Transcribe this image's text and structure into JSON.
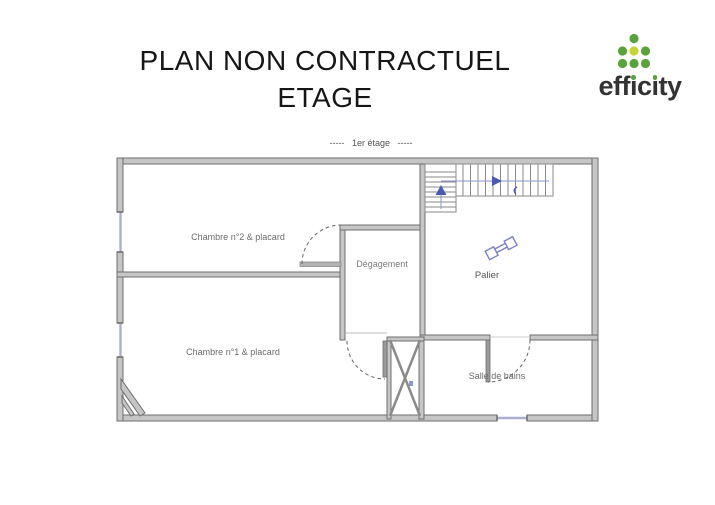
{
  "page": {
    "title_line1": "PLAN NON CONTRACTUEL",
    "title_line2": "ETAGE"
  },
  "logo": {
    "brand": "efficity",
    "brand_parts": {
      "pre": "eff",
      "i1": "ı",
      "mid": "c",
      "i2": "ı",
      "post": "ty"
    },
    "colors": {
      "dot_green": "#58a33c",
      "dot_yellow": "#c8d334",
      "text": "#333333"
    }
  },
  "plan": {
    "floor_label": "1er étage",
    "dashes_left": "----- ",
    "dashes_right": " -----",
    "rooms": [
      {
        "id": "chambre2",
        "label": "Chambre n°2 & placard"
      },
      {
        "id": "degagement",
        "label": "Dégagement"
      },
      {
        "id": "palier",
        "label": "Palier"
      },
      {
        "id": "chambre1",
        "label": "Chambre n°1 & placard"
      },
      {
        "id": "sdb",
        "label": "Salle de bains"
      }
    ],
    "colors": {
      "wall_fill": "#c6c6c6",
      "wall_stroke": "#6f6f6f",
      "stair_line": "#8a8a8a",
      "walk_blue": "#4a5ab0",
      "window_line": "#a9b0c9",
      "door_arc": "#666666",
      "label_text": "#6b6b6b"
    }
  }
}
